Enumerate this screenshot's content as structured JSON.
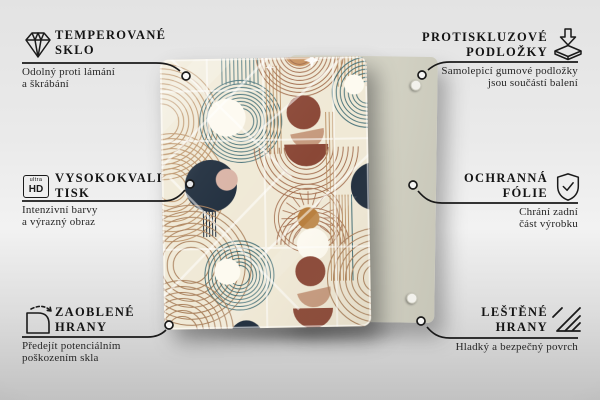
{
  "callouts": {
    "tempered_glass": {
      "icon": "diamond-icon",
      "title": "TEMPEROVANÉ\nSKLO",
      "subtitle": "Odolný proti lámání\na škrábání"
    },
    "antislip_pads": {
      "icon": "antislip-pads-icon",
      "title": "PROTISKLUZOVÉ\nPODLOŽKY",
      "subtitle": "Samolepicí gumové podložky\njsou součástí balení"
    },
    "hd_print": {
      "icon": "ultra-hd-icon",
      "icon_label_small": "ultra",
      "icon_label_big": "HD",
      "title": "VYSOKOKVALITNÍ\nTISK",
      "subtitle": "Intenzivní barvy\na výrazný obraz"
    },
    "protective_film": {
      "icon": "shield-check-icon",
      "title": "OCHRANNÁ\nFÓLIE",
      "subtitle": "Chrání zadní\nčást výrobku"
    },
    "rounded_edges": {
      "icon": "rounded-corner-icon",
      "title": "ZAOBLENÉ\nHRANY",
      "subtitle": "Předejít potenciálním\npoškozením skla"
    },
    "polished_edges": {
      "icon": "hatch-lines-icon",
      "title": "LEŠTĚNÉ\nHRANY",
      "subtitle": "Hladký a bezpečný povrch"
    }
  },
  "scene": {
    "front_board": "glass-board-with-abstract-pattern",
    "back_board": "plain-back-board-with-antislip-pads"
  },
  "artwork_colors": {
    "background": "#f0e9d6",
    "teal": "#3f6c74",
    "navy": "#1e2c3c",
    "brick": "#8a4736",
    "tan_fill": "#c69a7e",
    "pink": "#d9b3a5",
    "ochre": "#b87e3c",
    "line_brown": "#a06a4a",
    "line_tan": "#b98f63",
    "cream": "#fdfaf0",
    "back_board": "#d2d1c3",
    "connector": "#1a1a1a"
  }
}
